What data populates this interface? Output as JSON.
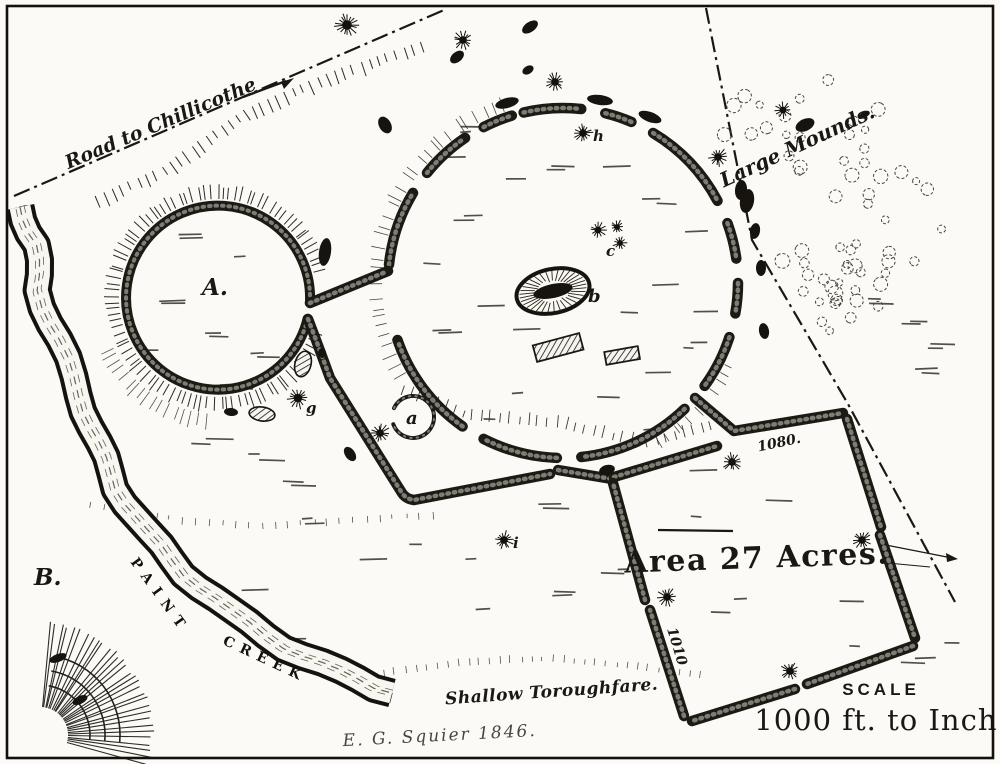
{
  "map": {
    "road_label": "Road to Chillicothe",
    "large_mounds_label": "Large Mounds.",
    "area_label": "Area 27 Acres.",
    "scale_heading": "SCALE",
    "scale_value": "1000 ft. to Inch.",
    "creek_name_word1": "PAINT",
    "creek_name_word2": "CREEK",
    "ford_label": "Shallow Toroughfare.",
    "surveyor_signature": "E. G. Squier 1846.",
    "elevation_labels": {
      "northeast_corner": "1080.",
      "southwest_wall": "1010"
    },
    "feature_letters": {
      "small_circle_enclosure": "A.",
      "bluff_point": "B.",
      "small_ring": "a",
      "central_oval_mound": "b",
      "mound_cluster": "c",
      "gateway_mound": "g",
      "north_mound": "h",
      "south_mound": "i"
    }
  },
  "colors": {
    "paper": "#fbfaf6",
    "ink": "#1b1813",
    "ink_light": "#564f44"
  }
}
